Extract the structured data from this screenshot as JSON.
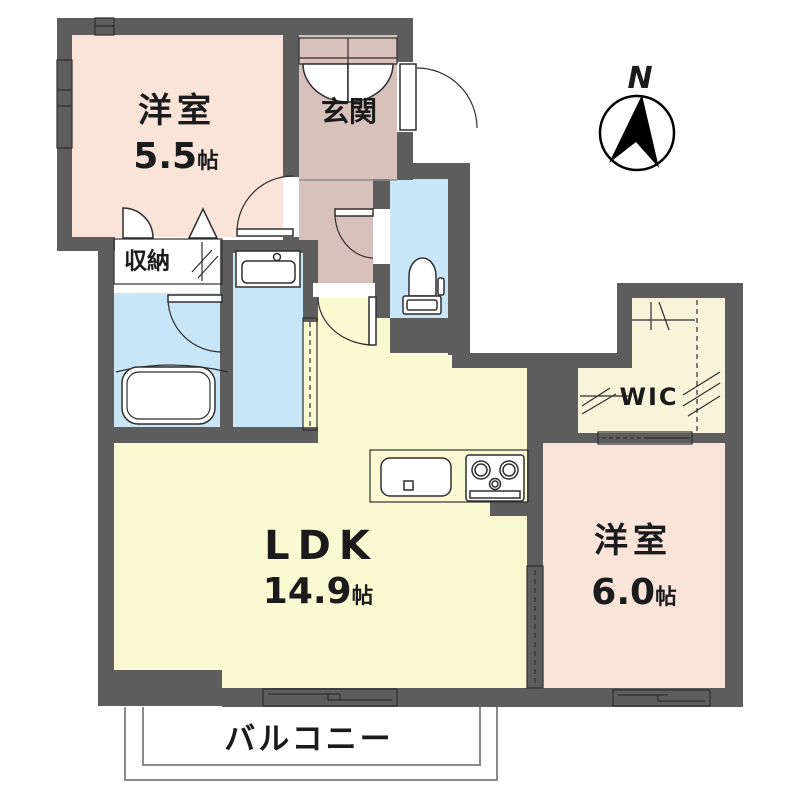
{
  "plan": {
    "compass": {
      "label": "N"
    },
    "rooms": {
      "bedroom1": {
        "name": "洋室",
        "size": "5.5",
        "unit": "帖"
      },
      "entrance": {
        "name": "玄関"
      },
      "storage": {
        "name": "収納"
      },
      "ldk": {
        "name": "LDK",
        "size": "14.9",
        "unit": "帖"
      },
      "wic": {
        "name": "WIC"
      },
      "bedroom2": {
        "name": "洋室",
        "size": "6.0",
        "unit": "帖"
      },
      "balcony": {
        "name": "バルコニー"
      }
    },
    "colors": {
      "wall": "#5d5d5d",
      "room-pink": "#fae3d9",
      "room-mauve": "#d9c1bb",
      "room-cream": "#f8f4da",
      "room-yellow": "#fafad2",
      "room-blue": "#c9e6f8",
      "balcony-line": "#8a8a8a",
      "text": "#1b1b1b"
    }
  }
}
